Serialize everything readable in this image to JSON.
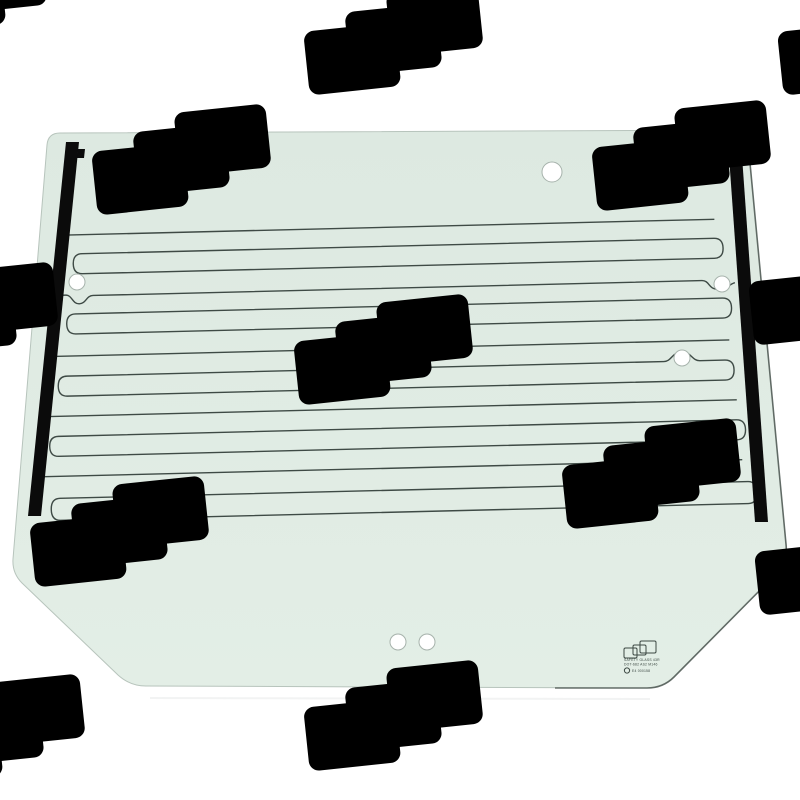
{
  "scene": {
    "subject": "tractor-rear-window-glass-panel",
    "style": "catalog product photo on white background with watermark"
  },
  "stamp": {
    "line1": "SAFETY GLASS 43R",
    "line2": "DOT-682 AS2 M146",
    "line3": "E4 000158"
  },
  "watermark": {
    "shape": "overlapping rounded rectangles",
    "groups": 12
  },
  "colors": {
    "glass_top": "#dde9e1",
    "glass_bottom": "#e3eee6",
    "glass_edge": "#b7c4bc",
    "edge_dark": "#49534e",
    "line_color": "#3e4a45",
    "bar_color": "#0b0b0b",
    "hole_ring": "#a7b3ac",
    "wm_color": "rgba(125,135,130,0.35)",
    "stamp_color": "#3c4843"
  }
}
